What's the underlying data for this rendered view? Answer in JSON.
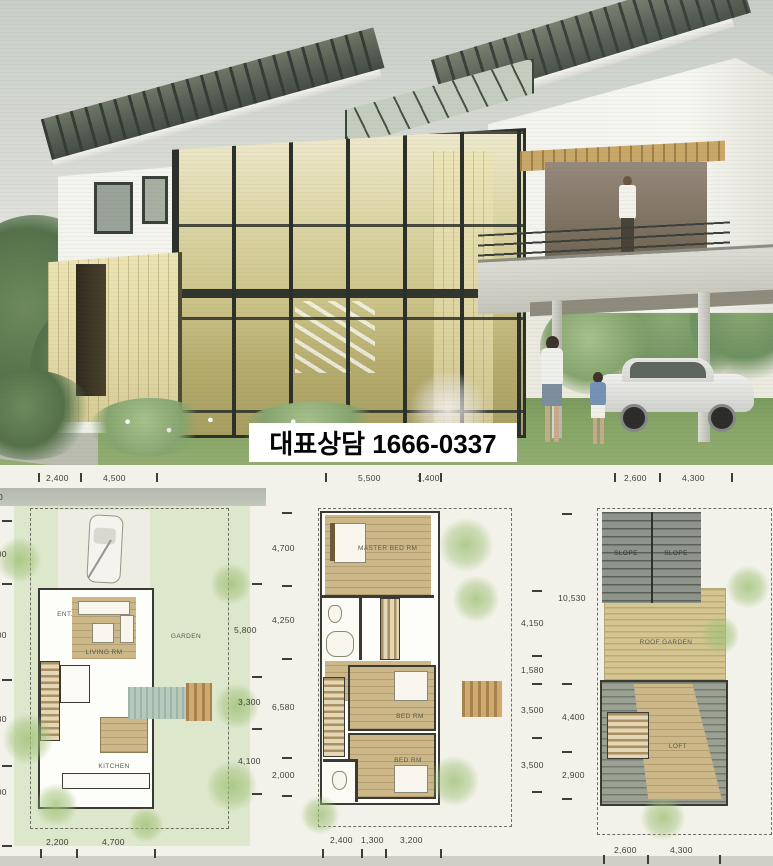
{
  "banner": {
    "text": "대표상담 1666-0337"
  },
  "floor_plans": {
    "plan1": {
      "labels": {
        "ent": "ENT.",
        "living": "LIVING RM",
        "garden": "GARDEN",
        "kitchen": "KITCHEN"
      },
      "dims": {
        "top": [
          "2,400",
          "4,500"
        ],
        "bottom": [
          "2,200",
          "4,700"
        ],
        "left": [
          "500",
          "1,800",
          "4,500",
          "1,230",
          "1,000"
        ],
        "right": [
          "5,800",
          "3,300",
          "4,100"
        ]
      }
    },
    "plan2": {
      "labels": {
        "master": "MASTER BED RM",
        "bed1": "BED RM",
        "bed2": "BED RM"
      },
      "dims": {
        "top": [
          "5,500",
          "1,400"
        ],
        "bottom": [
          "2,400",
          "1,300",
          "3,200"
        ],
        "left": [
          "4,700",
          "4,250",
          "6,580",
          "2,000"
        ],
        "right": [
          "4,150",
          "1,580",
          "3,500",
          "3,500"
        ]
      }
    },
    "plan3": {
      "labels": {
        "slope1": "SLOPE",
        "slope2": "SLOPE",
        "roof_garden": "ROOF GARDEN",
        "loft": "LOFT"
      },
      "dims": {
        "top": [
          "2,600",
          "4,300"
        ],
        "bottom": [
          "2,600",
          "4,300"
        ],
        "left": [
          "10,530",
          "4,400",
          "2,900"
        ]
      }
    }
  }
}
